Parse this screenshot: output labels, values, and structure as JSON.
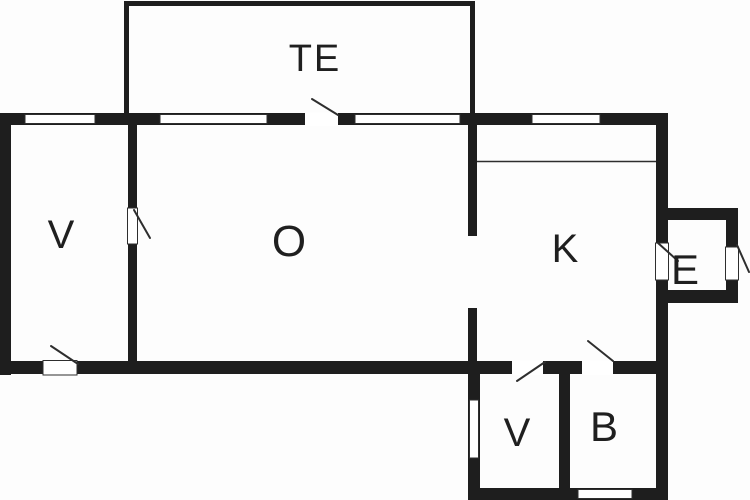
{
  "colors": {
    "wall": "#1e1e1e",
    "line": "#2e2e2e",
    "label": "#1f1f1f",
    "background": "#fdfdfd"
  },
  "rooms": {
    "te": {
      "label": "TE"
    },
    "v_left": {
      "label": "V"
    },
    "o": {
      "label": "O"
    },
    "k": {
      "label": "K"
    },
    "e": {
      "label": "E"
    },
    "v_small": {
      "label": "V"
    },
    "b": {
      "label": "B"
    }
  }
}
